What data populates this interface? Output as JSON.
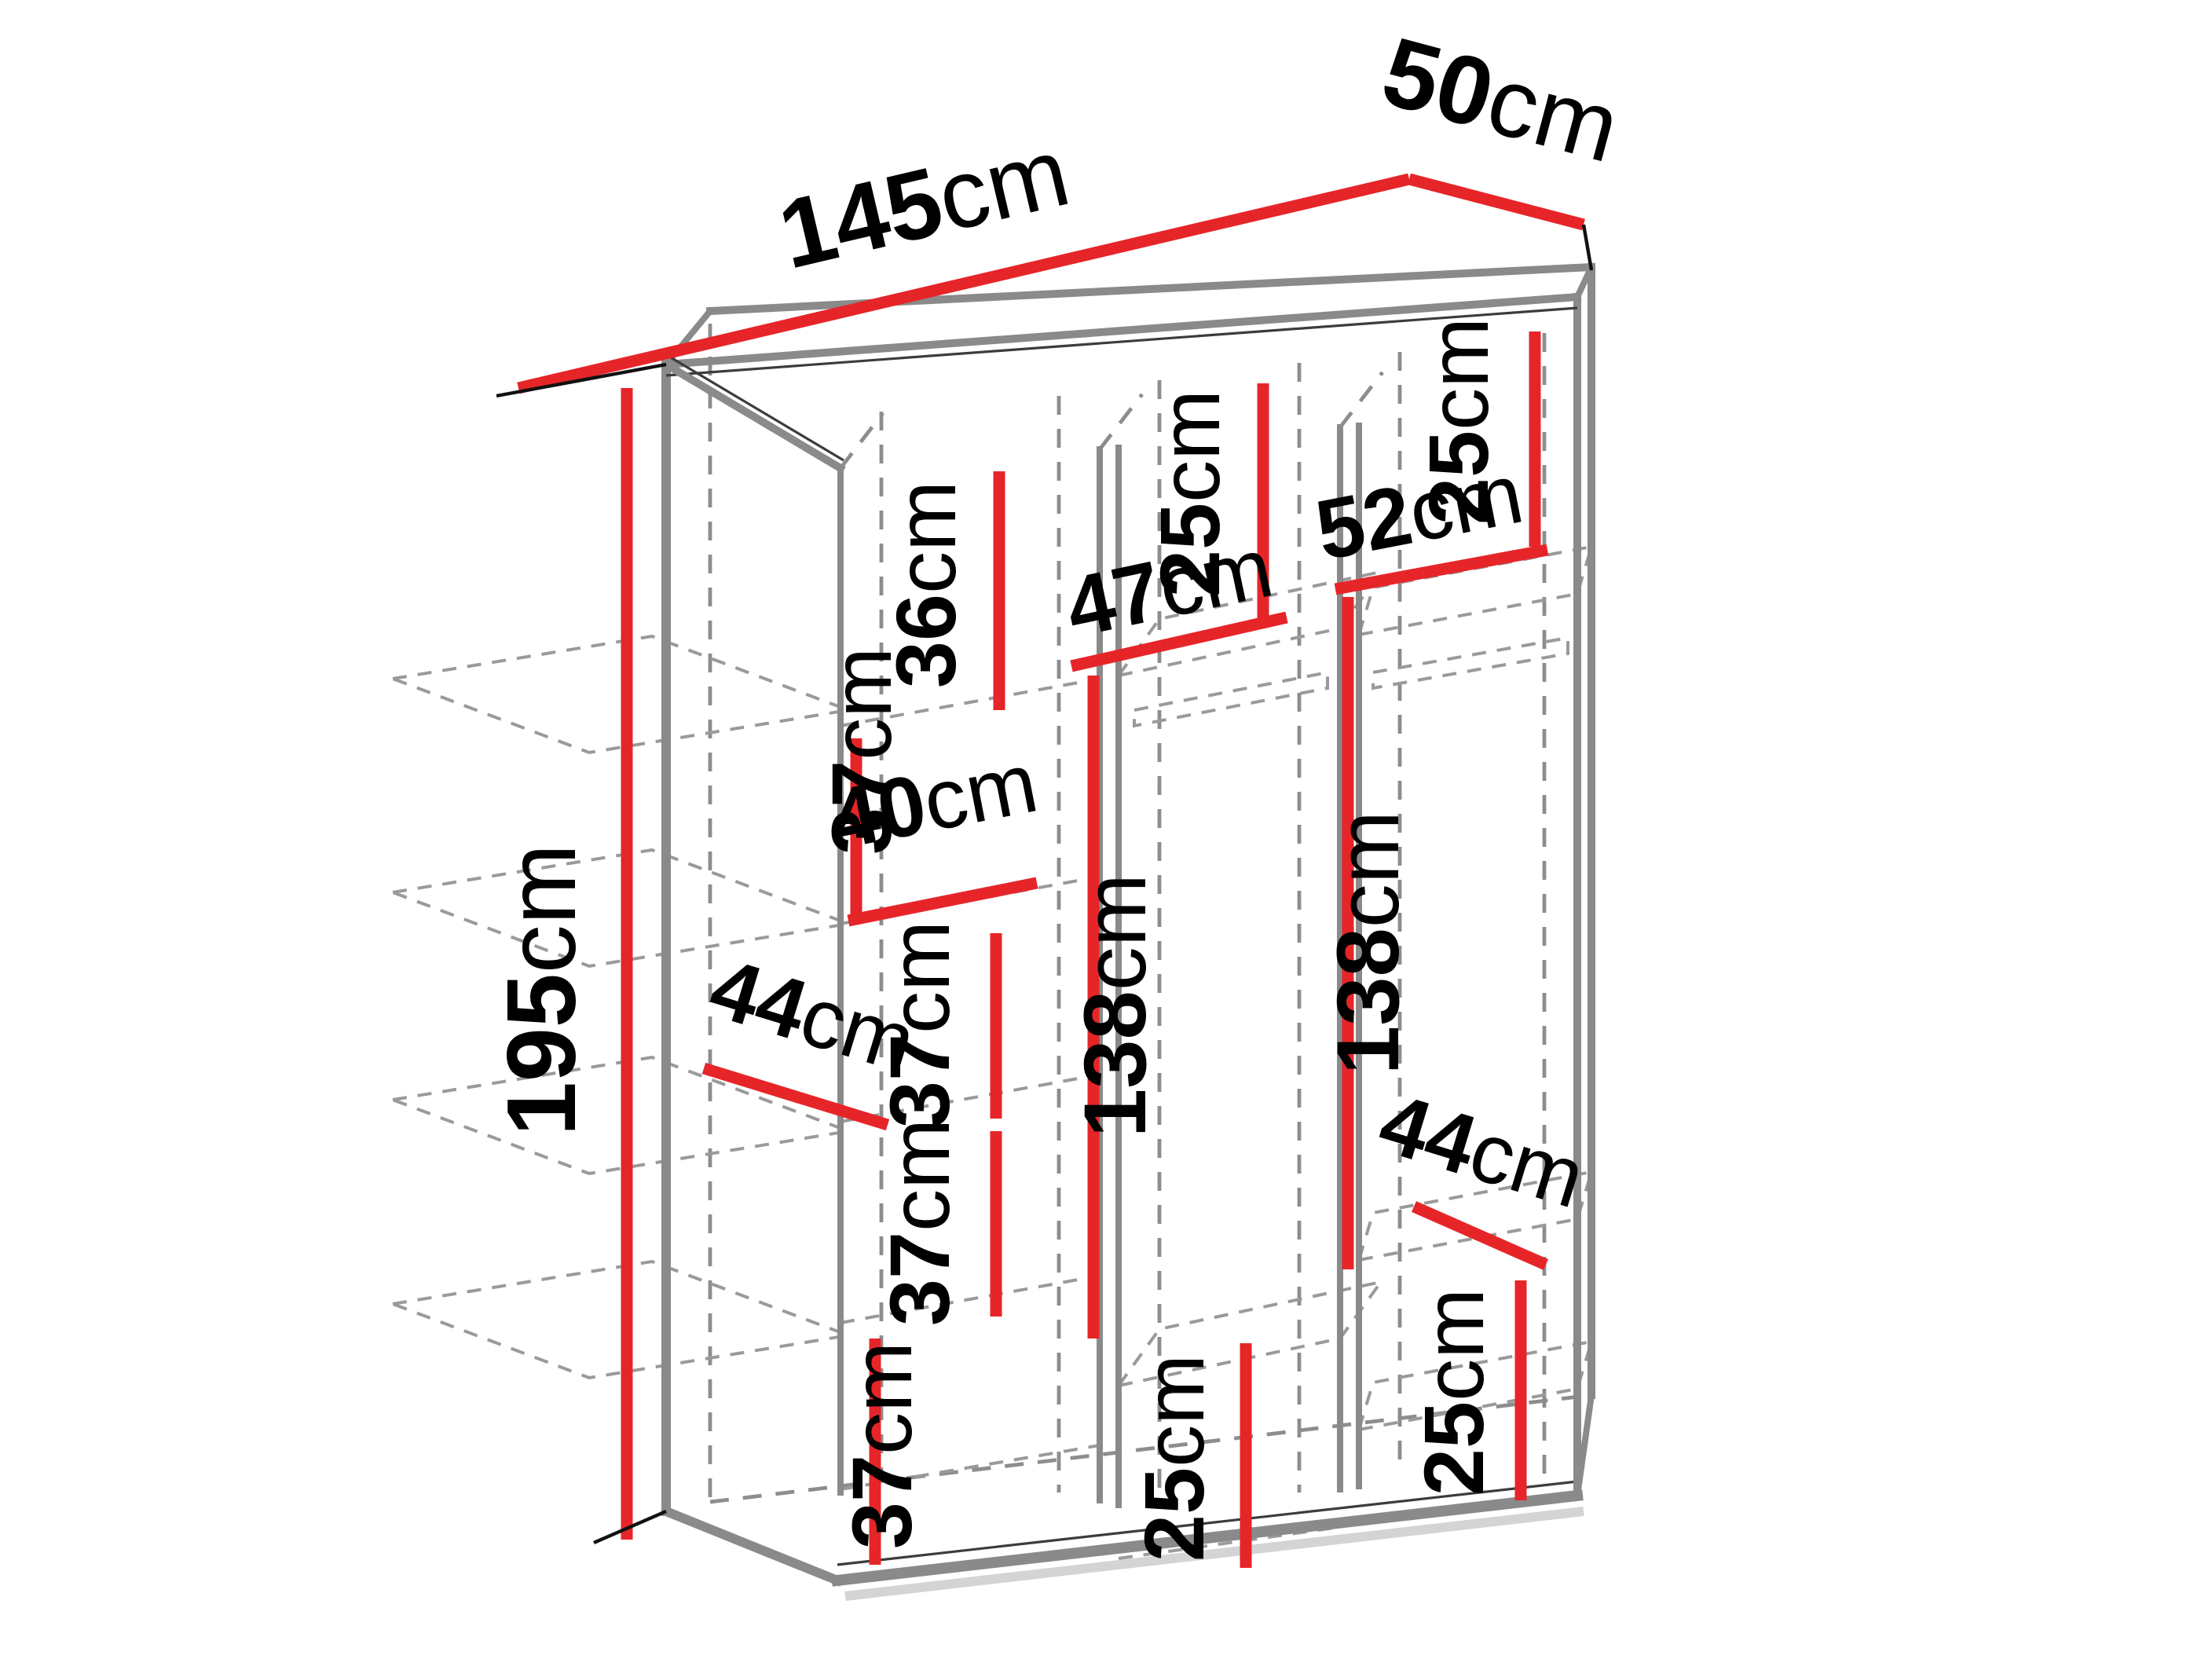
{
  "title": "Wardrobe dimension diagram",
  "unit": "cm",
  "colors": {
    "dimension_red": "#e62529",
    "structure_gray": "#8a8a8a",
    "hidden_line_gray": "#8d8d8d",
    "text_black": "#000000",
    "background": "#ffffff"
  },
  "overall": {
    "width": "145",
    "depth": "50",
    "height": "195"
  },
  "sections": {
    "left_column": {
      "top_cell": "36",
      "cell2": "37",
      "shelf_width": "40",
      "shelf_depth": "44",
      "cell3": "37",
      "cell4": "37",
      "bottom_cell": "37"
    },
    "middle_column": {
      "width": "47",
      "top_cell": "25",
      "hanging_height": "138",
      "bottom_cell": "25"
    },
    "right_column": {
      "width": "52",
      "top_cell": "25",
      "hanging_height": "138",
      "shelf_depth": "44",
      "bottom_cell": "25"
    }
  }
}
